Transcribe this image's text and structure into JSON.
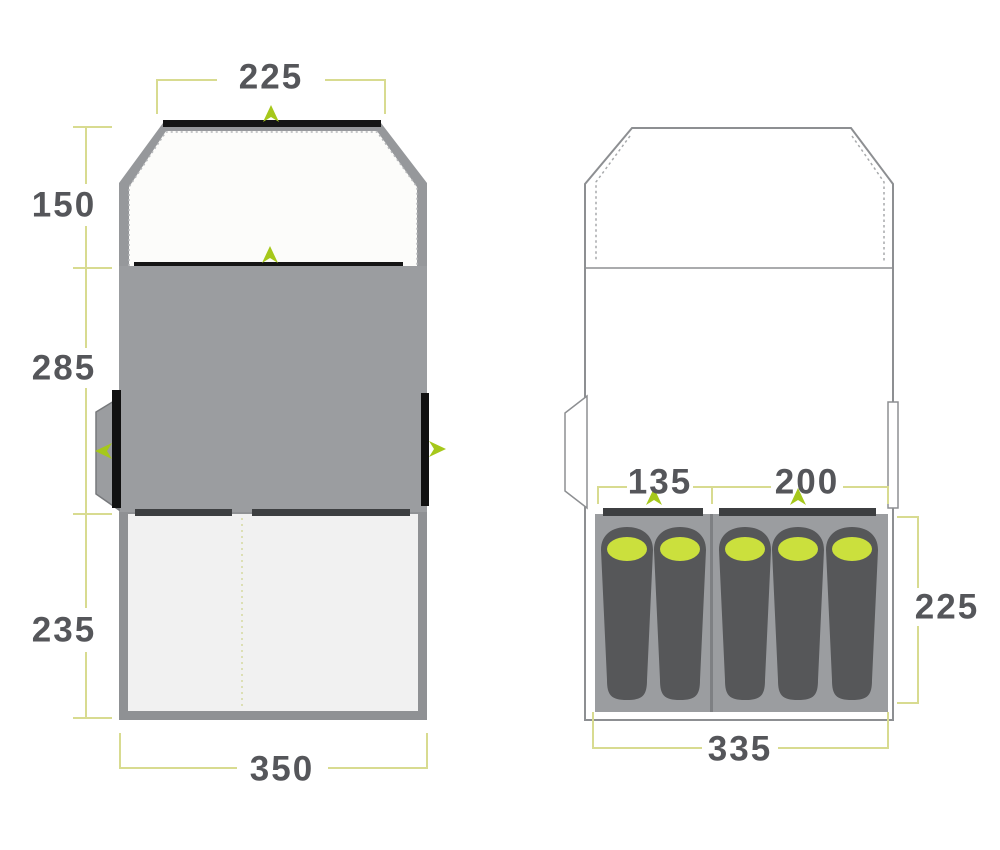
{
  "title": "Tent floorplan diagram",
  "left_view": {
    "description": "floorplan with shaded sections",
    "top_width": "225",
    "porch_depth": "150",
    "living_area_depth": "285",
    "bedroom_depth": "235",
    "total_width": "350"
  },
  "right_view": {
    "description": "floorplan with sleeping bags",
    "bedroom_left_width": "135",
    "bedroom_right_width": "200",
    "bedroom_depth": "225",
    "bedroom_total_width": "335",
    "sleeping_bag_count": 5
  },
  "icons": {
    "door_arrow": "door-arrow-icon"
  },
  "colors": {
    "accent_green": "#a6c81b",
    "sleeping_bag_top_green": "#cbe03d",
    "dimension_line_olive": "#d8db90",
    "label_text": "#55565a",
    "tent_gray": "#9b9da0",
    "dark_door_bar": "#3d3f41",
    "black_door": "#151515"
  }
}
